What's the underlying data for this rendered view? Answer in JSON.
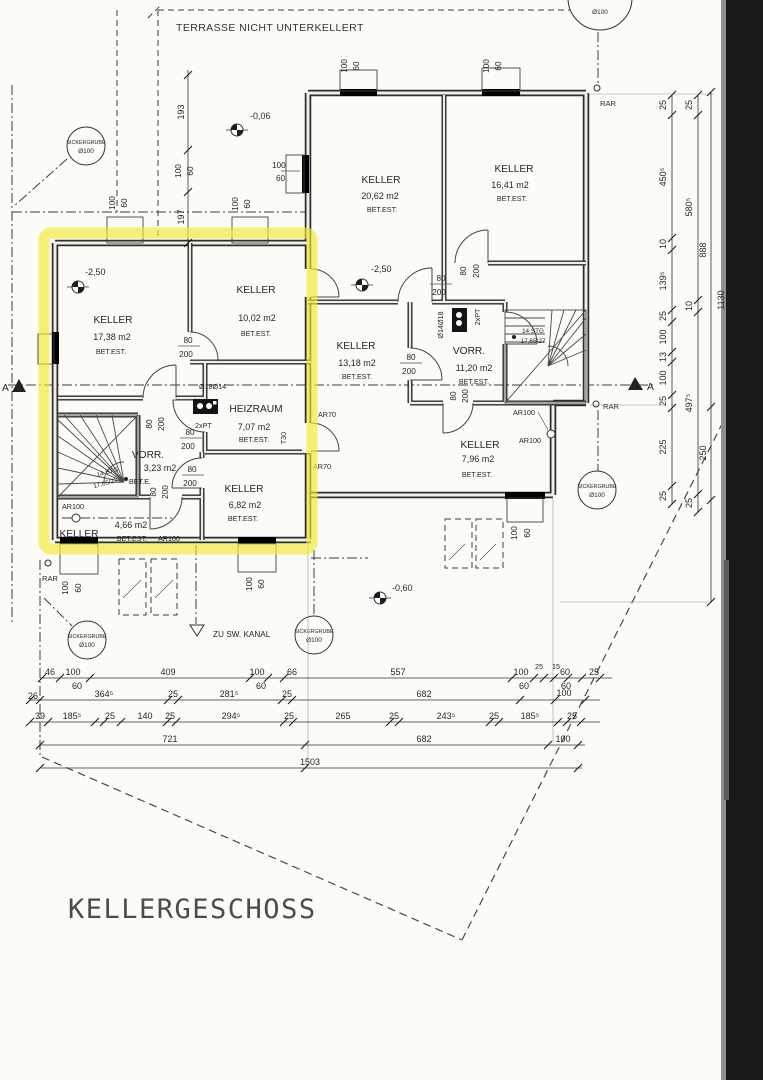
{
  "title": "KELLERGESCHOSS",
  "terrace": "TERRASSE NICHT UNTERKELLERT",
  "kanal": "ZU SW. KANAL",
  "rooms": [
    {
      "name": "KELLER",
      "area": "20,62 m2",
      "floor": "BET.EST."
    },
    {
      "name": "KELLER",
      "area": "16,41 m2",
      "floor": "BET.EST."
    },
    {
      "name": "KELLER",
      "area": "17,38 m2",
      "floor": "BET.EST."
    },
    {
      "name": "KELLER",
      "area": "10,02 m2",
      "floor": "BET.EST."
    },
    {
      "name": "KELLER",
      "area": "13,18 m2",
      "floor": "BET.EST."
    },
    {
      "name": "VORR.",
      "area": "11,20 m2",
      "floor": "BET.EST."
    },
    {
      "name": "HEIZRAUM",
      "area": "7,07 m2",
      "floor": "BET.EST."
    },
    {
      "name": "VORR.",
      "area": "3,23 m2",
      "floor": "BET.E."
    },
    {
      "name": "KELLER",
      "area": "6,82 m2",
      "floor": "BET.EST."
    },
    {
      "name": "KELLER",
      "area": "4,66 m2",
      "floor": "BET.EST."
    },
    {
      "name": "KELLER",
      "area": "7,96 m2",
      "floor": "BET.EST."
    }
  ],
  "levels": {
    "top": "-0,06",
    "mid": "-2,50",
    "left": "-2,50",
    "bottom": "-0,60"
  },
  "stair": {
    "l1": "14 STG",
    "l2": "17,65/27"
  },
  "sicker": {
    "l1": "SICKERGRUBE",
    "l2": "Ø100"
  },
  "lbl": {
    "rar": "RAR",
    "ar100": "AR100",
    "ar70": "AR70",
    "pt": "2xPT",
    "t30": "T30",
    "d1814": "Ø18Ø14",
    "d1418": "Ø14Ø18",
    "a": "A"
  },
  "door": {
    "w": "80",
    "h": "200"
  },
  "win": {
    "w": "100",
    "h": "60"
  },
  "dims": {
    "top": [
      "193",
      "197"
    ],
    "r1": [
      "46",
      "409",
      "66",
      "557",
      "25",
      "15",
      "25"
    ],
    "r2": [
      "26",
      "364⁵",
      "25",
      "281⁵",
      "25",
      "682",
      "100"
    ],
    "r3": [
      "39",
      "185⁵",
      "25",
      "140",
      "25",
      "294⁵",
      "25",
      "265",
      "25",
      "243⁵",
      "25",
      "185⁵",
      "25"
    ],
    "r4": [
      "721",
      "682",
      "100"
    ],
    "r5": [
      "1503"
    ],
    "c1": [
      "25",
      "450⁵",
      "10",
      "139⁵",
      "25",
      "100",
      "13",
      "100",
      "25",
      "225",
      "25"
    ],
    "c2": [
      "25",
      "580⁵",
      "10",
      "497⁵",
      "25"
    ],
    "c3": [
      "888",
      "1130",
      "250"
    ]
  }
}
